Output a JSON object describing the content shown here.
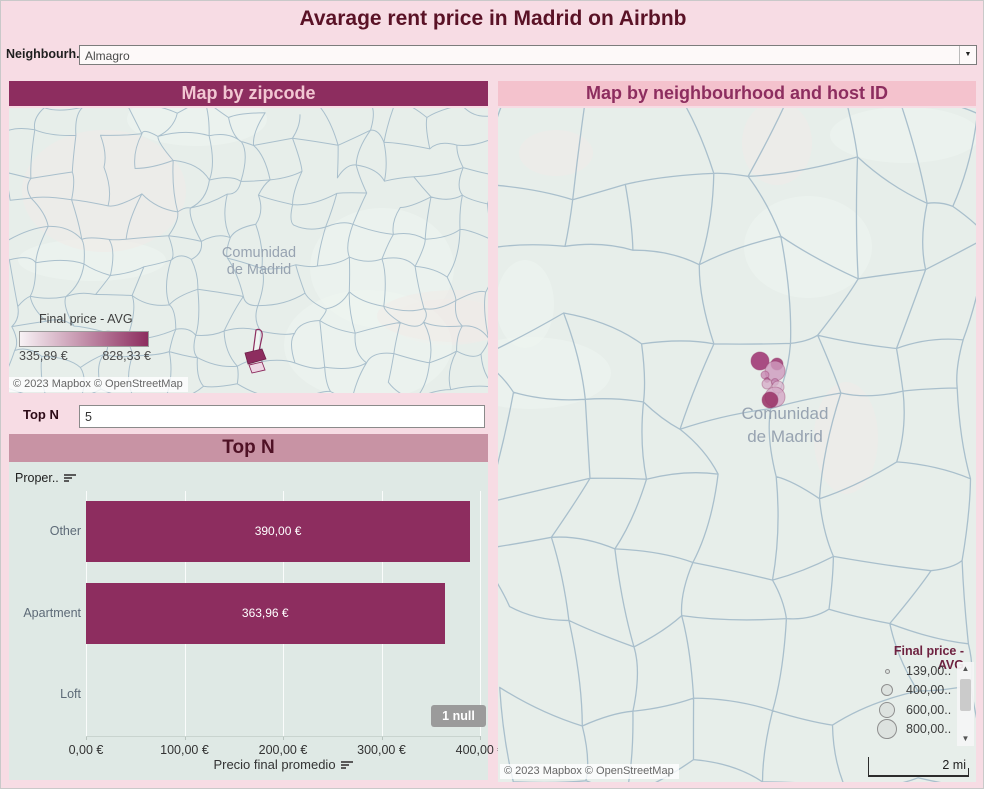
{
  "page": {
    "title": "Avarage rent price in Madrid on Airbnb"
  },
  "filter": {
    "label": "Neighbourh..",
    "value": "Almagro"
  },
  "left_map": {
    "header": "Map by zipcode",
    "region_label_line1": "Comunidad",
    "region_label_line2": "de Madrid",
    "legend": {
      "title": "Final price - AVG",
      "min_label": "335,89 €",
      "max_label": "828,33 €",
      "gradient_from": "#f8f2f5",
      "gradient_to": "#8d2d5f"
    },
    "attribution": "© 2023 Mapbox © OpenStreetMap"
  },
  "top_n_control": {
    "label": "Top N",
    "value": "5"
  },
  "chart_data": {
    "type": "bar",
    "orientation": "horizontal",
    "title": "Top N",
    "field_label": "Proper..",
    "categories": [
      "Other",
      "Apartment",
      "Loft"
    ],
    "values": [
      390.0,
      363.96,
      null
    ],
    "value_labels": [
      "390,00 €",
      "363,96 €",
      ""
    ],
    "xlabel": "Precio final promedio",
    "xlim": [
      0,
      400
    ],
    "x_ticks": [
      0,
      100,
      200,
      300,
      400
    ],
    "x_tick_labels": [
      "0,00 €",
      "100,00 €",
      "200,00 €",
      "300,00 €",
      "400,00 €"
    ],
    "null_badge": "1 null",
    "bar_color": "#8d2d5f",
    "grid": true,
    "legend_position": "none"
  },
  "right_map": {
    "header": "Map by neighbourhood and host ID",
    "region_label_line1": "Comunidad",
    "region_label_line2": "de Madrid",
    "legend": {
      "title": "Final price - AVG",
      "items": [
        {
          "label": "139,00..",
          "r": 2.5
        },
        {
          "label": "400,00..",
          "r": 6
        },
        {
          "label": "600,00..",
          "r": 8
        },
        {
          "label": "800,00..",
          "r": 10
        }
      ]
    },
    "bubbles": [
      {
        "x": 262,
        "y": 253,
        "r": 9,
        "fill": "#a23b77",
        "opacity": 0.9
      },
      {
        "x": 279,
        "y": 256,
        "r": 6,
        "fill": "#9c3570",
        "opacity": 0.85
      },
      {
        "x": 277,
        "y": 263,
        "r": 10,
        "fill": "#cf9bbf",
        "opacity": 0.8
      },
      {
        "x": 267,
        "y": 267,
        "r": 4,
        "fill": "#c98bb4",
        "opacity": 0.8
      },
      {
        "x": 269,
        "y": 272,
        "r": 2.5,
        "fill": "#b06394",
        "opacity": 0.85
      },
      {
        "x": 269,
        "y": 276,
        "r": 5,
        "fill": "#d7afca",
        "opacity": 0.8
      },
      {
        "x": 277,
        "y": 274,
        "r": 3.5,
        "fill": "#c285b0",
        "opacity": 0.8
      },
      {
        "x": 280,
        "y": 279,
        "r": 6,
        "fill": "#dab7cf",
        "opacity": 0.75
      },
      {
        "x": 277,
        "y": 289,
        "r": 10,
        "fill": "#d5a8c6",
        "opacity": 0.8
      },
      {
        "x": 272,
        "y": 292,
        "r": 8,
        "fill": "#993065",
        "opacity": 0.85
      }
    ],
    "scale_label": "2 mi",
    "attribution": "© 2023 Mapbox © OpenStreetMap"
  },
  "colors": {
    "page_bg": "#f7dce4",
    "title_text": "#5a1226",
    "header_dark_bg": "#8d2d5f",
    "header_pink_bg": "#f4c2cd",
    "header_mauve_bg": "#c893a4",
    "map_bg": "#e7eeea",
    "map_line": "#a9bfcc",
    "chart_bg": "#dfe9e5",
    "bar": "#8d2d5f",
    "null_badge_bg": "#9b9b9b"
  }
}
